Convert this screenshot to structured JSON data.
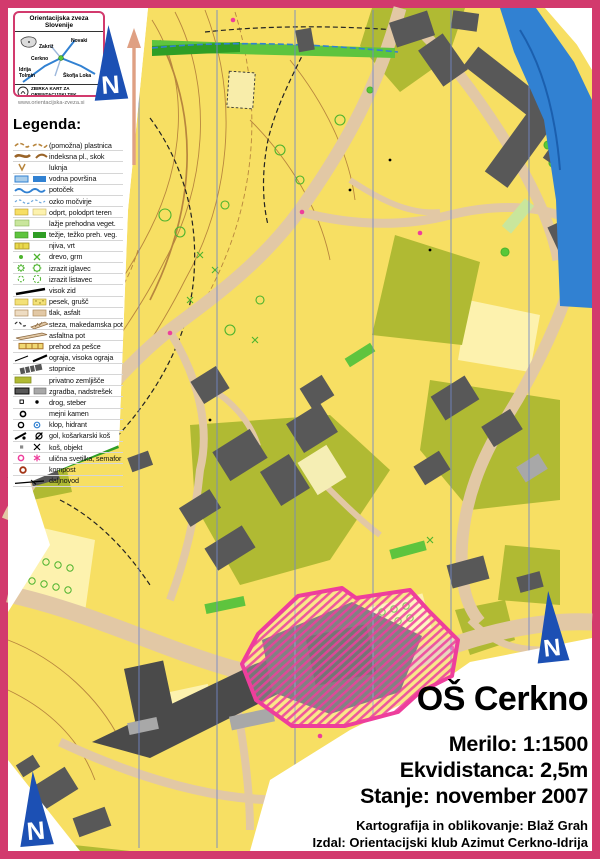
{
  "palette": {
    "frame": "#d23a6d",
    "map-yellow": "#f7df63",
    "pale-yellow": "#fdf2ae",
    "olive": "#b0ba33",
    "green-light": "#c9e69c",
    "green": "#5ec43e",
    "green-dark": "#2f9e25",
    "tan": "#e2c8a5",
    "contour": "#b8863e",
    "building": "#585858",
    "building-dark": "#4a4a4a",
    "building-light": "#a8a8a8",
    "water": "#3181d2",
    "magenta": "#ee3e9c",
    "arrow-blue": "#1c50b4",
    "meridian": "#7388c7",
    "salmon": "#dfa083"
  },
  "logo_box": {
    "title": "Orientacijska zveza Slovenije",
    "places": [
      "Zakriž",
      "Novaki",
      "Cerkno",
      "Idrija",
      "Tolmin",
      "Škofja Loka"
    ],
    "footer_line1": "ZBIRKA KART ZA",
    "footer_line2": "ORIENTACIJSKI TEK",
    "url": "www.orientacijska-zveza.si"
  },
  "north_arrow": {
    "letter": "N"
  },
  "legend": {
    "title": "Legenda:",
    "items": [
      {
        "symbol": "contour-aux-icon",
        "label": "(pomožna) plastnica"
      },
      {
        "symbol": "contour-index-icon",
        "label": "indeksna pl., skok"
      },
      {
        "symbol": "hole-icon",
        "label": "luknja"
      },
      {
        "symbol": "water-area-icon",
        "label": "vodna površina"
      },
      {
        "symbol": "stream-icon",
        "label": "potoček"
      },
      {
        "symbol": "marsh-icon",
        "label": "ozko močvirje"
      },
      {
        "symbol": "open-terrain-icon",
        "label": "odprt, polodprt teren"
      },
      {
        "symbol": "veg-easy-icon",
        "label": "lažje prehodna veget."
      },
      {
        "symbol": "veg-hard-icon",
        "label": "težje, težko preh. veg."
      },
      {
        "symbol": "field-icon",
        "label": "njiva, vrt"
      },
      {
        "symbol": "tree-bush-icon",
        "label": "drevo, grm"
      },
      {
        "symbol": "conifer-icon",
        "label": "izrazit iglavec"
      },
      {
        "symbol": "deciduous-icon",
        "label": "izrazit listavec"
      },
      {
        "symbol": "wall-icon",
        "label": "visok zid"
      },
      {
        "symbol": "sand-icon",
        "label": "pesek, grušč"
      },
      {
        "symbol": "paved-icon",
        "label": "tlak, asfalt"
      },
      {
        "symbol": "path-gravel-icon",
        "label": "steza, makedamska pot"
      },
      {
        "symbol": "asphalt-path-icon",
        "label": "asfaltna pot"
      },
      {
        "symbol": "crossing-icon",
        "label": "prehod za pešce"
      },
      {
        "symbol": "fence-icon",
        "label": "ograja, visoka ograja"
      },
      {
        "symbol": "stairs-icon",
        "label": "stopnice"
      },
      {
        "symbol": "private-land-icon",
        "label": "privatno zemljišče"
      },
      {
        "symbol": "building-icon",
        "label": "zgradba, nadstrešek"
      },
      {
        "symbol": "pole-icon",
        "label": "drog, steber"
      },
      {
        "symbol": "boundary-stone-icon",
        "label": "mejni kamen"
      },
      {
        "symbol": "bench-hydrant-icon",
        "label": "klop, hidrant"
      },
      {
        "symbol": "goal-basket-icon",
        "label": "gol, košarkarski koš"
      },
      {
        "symbol": "bin-object-icon",
        "label": "koš, objekt"
      },
      {
        "symbol": "lamp-semaphore-icon",
        "label": "ulična svetilka, semafor"
      },
      {
        "symbol": "compost-icon",
        "label": "kompost"
      },
      {
        "symbol": "powerline-icon",
        "label": "daljnovod"
      }
    ]
  },
  "title_block": {
    "title": "OŠ Cerkno",
    "scale": "Merilo: 1:1500",
    "equidistance": "Ekvidistanca: 2,5m",
    "status": "Stanje: november 2007",
    "credit_cartography": "Kartografija in oblikovanje: Blaž Grah",
    "credit_publisher": "Izdal: Orientacijski klub Azimut Cerkno-Idrija"
  }
}
